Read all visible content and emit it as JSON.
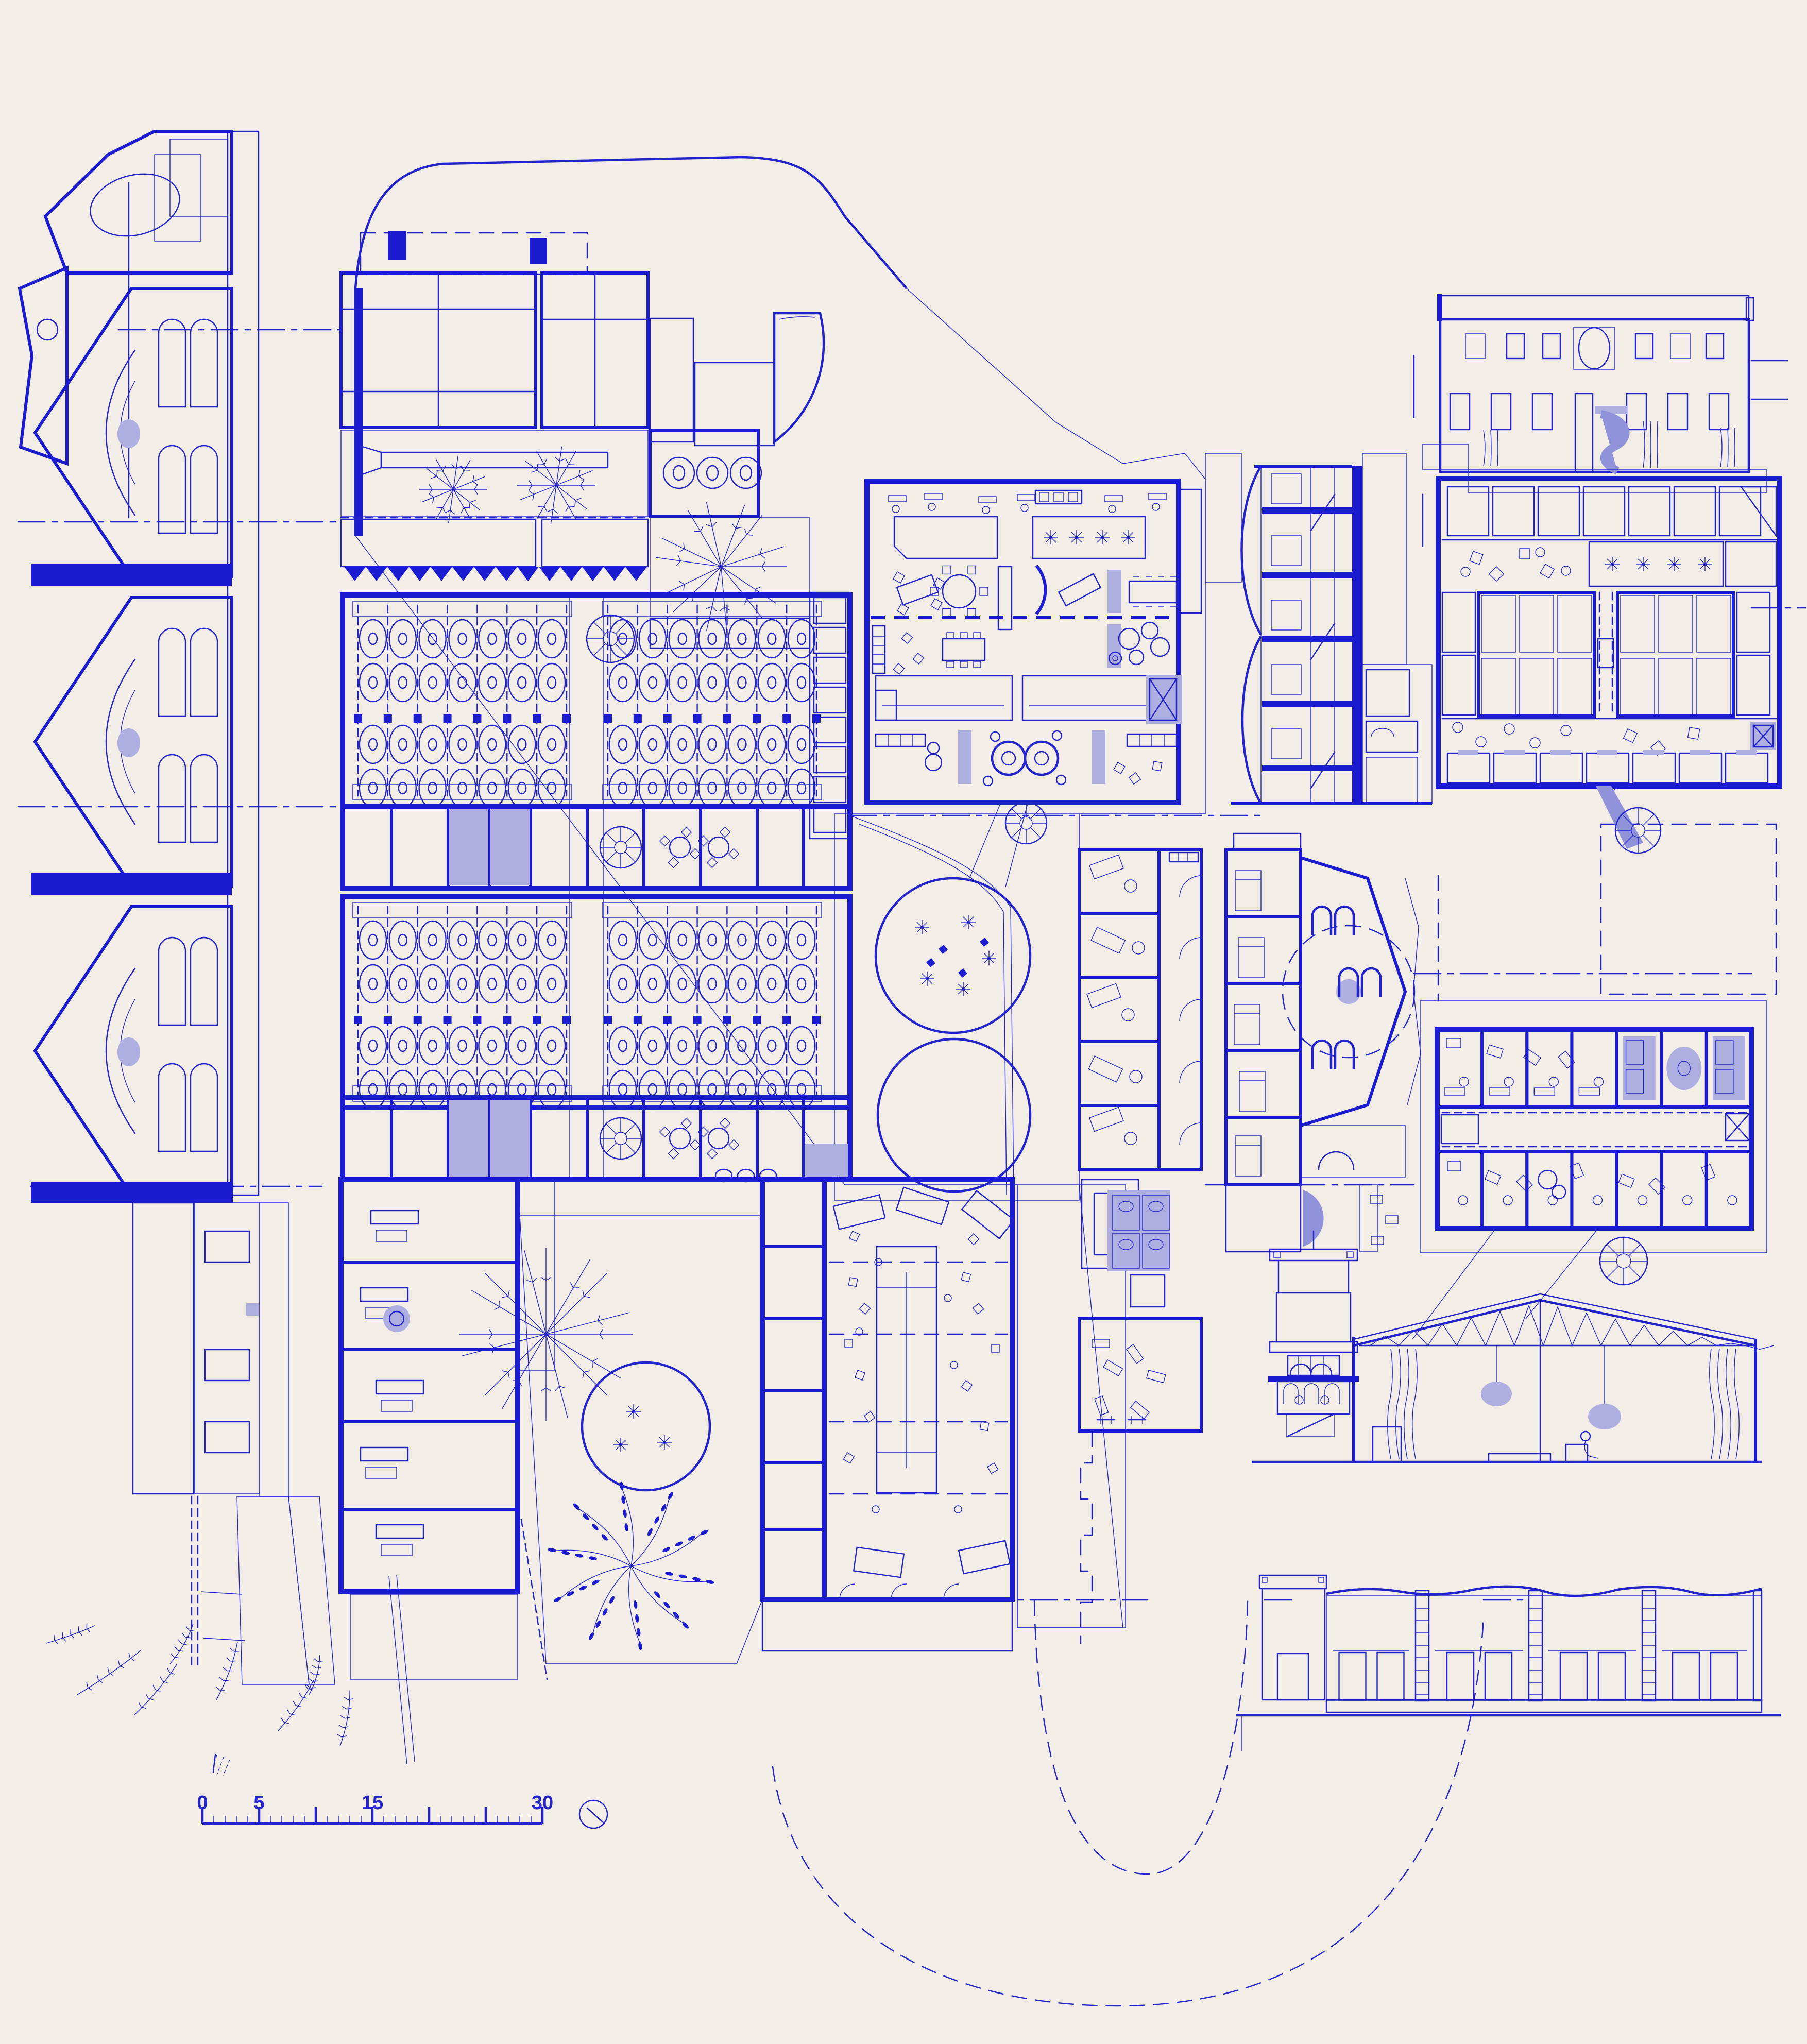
{
  "document": {
    "kind": "architectural-blueprint-presentation",
    "media": "blue ink linework on cream paper",
    "title_text_visible": false
  },
  "colors": {
    "paper": "#f2ede6",
    "ink": "#2323cb",
    "ink_strong": "#1b1bd0",
    "hatch": "#3434cf",
    "stipple": "#8585d6",
    "lavender": "#aeaee0",
    "lavender_deep": "#9193da",
    "wood": "#7b7bd4"
  },
  "scale_bar": {
    "labels": [
      "0",
      "5",
      "15",
      "30"
    ],
    "label_values": [
      0,
      5,
      15,
      30
    ],
    "major_tick_values": [
      0,
      5,
      10,
      15,
      20,
      25,
      30
    ],
    "minor_tick_step": 1,
    "pixels_per_unit": 22
  },
  "north_icon": "compass-circle-with-needle",
  "panels": [
    "west-wing-long-section",
    "main-winery-ground-plan",
    "vat-hall-with-tank-grid",
    "communal-open-plan-level",
    "stacked-dwelling-cross-section",
    "street-elevation-with-oval-window",
    "upper-floor-glass-roof-plan",
    "garden-court-with-round-beds",
    "narrow-room-wing-plan",
    "hexagonal-hall-plan",
    "dormitory-floor-plan",
    "tower-and-trussed-hall-section",
    "lower-street-elevation",
    "site-boundary-dashed-curves"
  ],
  "vat_hall": {
    "halls": 2,
    "blocks_per_hall": 2,
    "columns_per_block": 7,
    "rows_per_hall": 4,
    "total_tanks": 112
  },
  "dormitory_plan": {
    "rooms_top_row": 7,
    "rooms_bottom_row": 7
  },
  "elevation_windows": {
    "upper_row_openings": 7,
    "lower_row_openings": 7,
    "oval_windows": 1
  }
}
